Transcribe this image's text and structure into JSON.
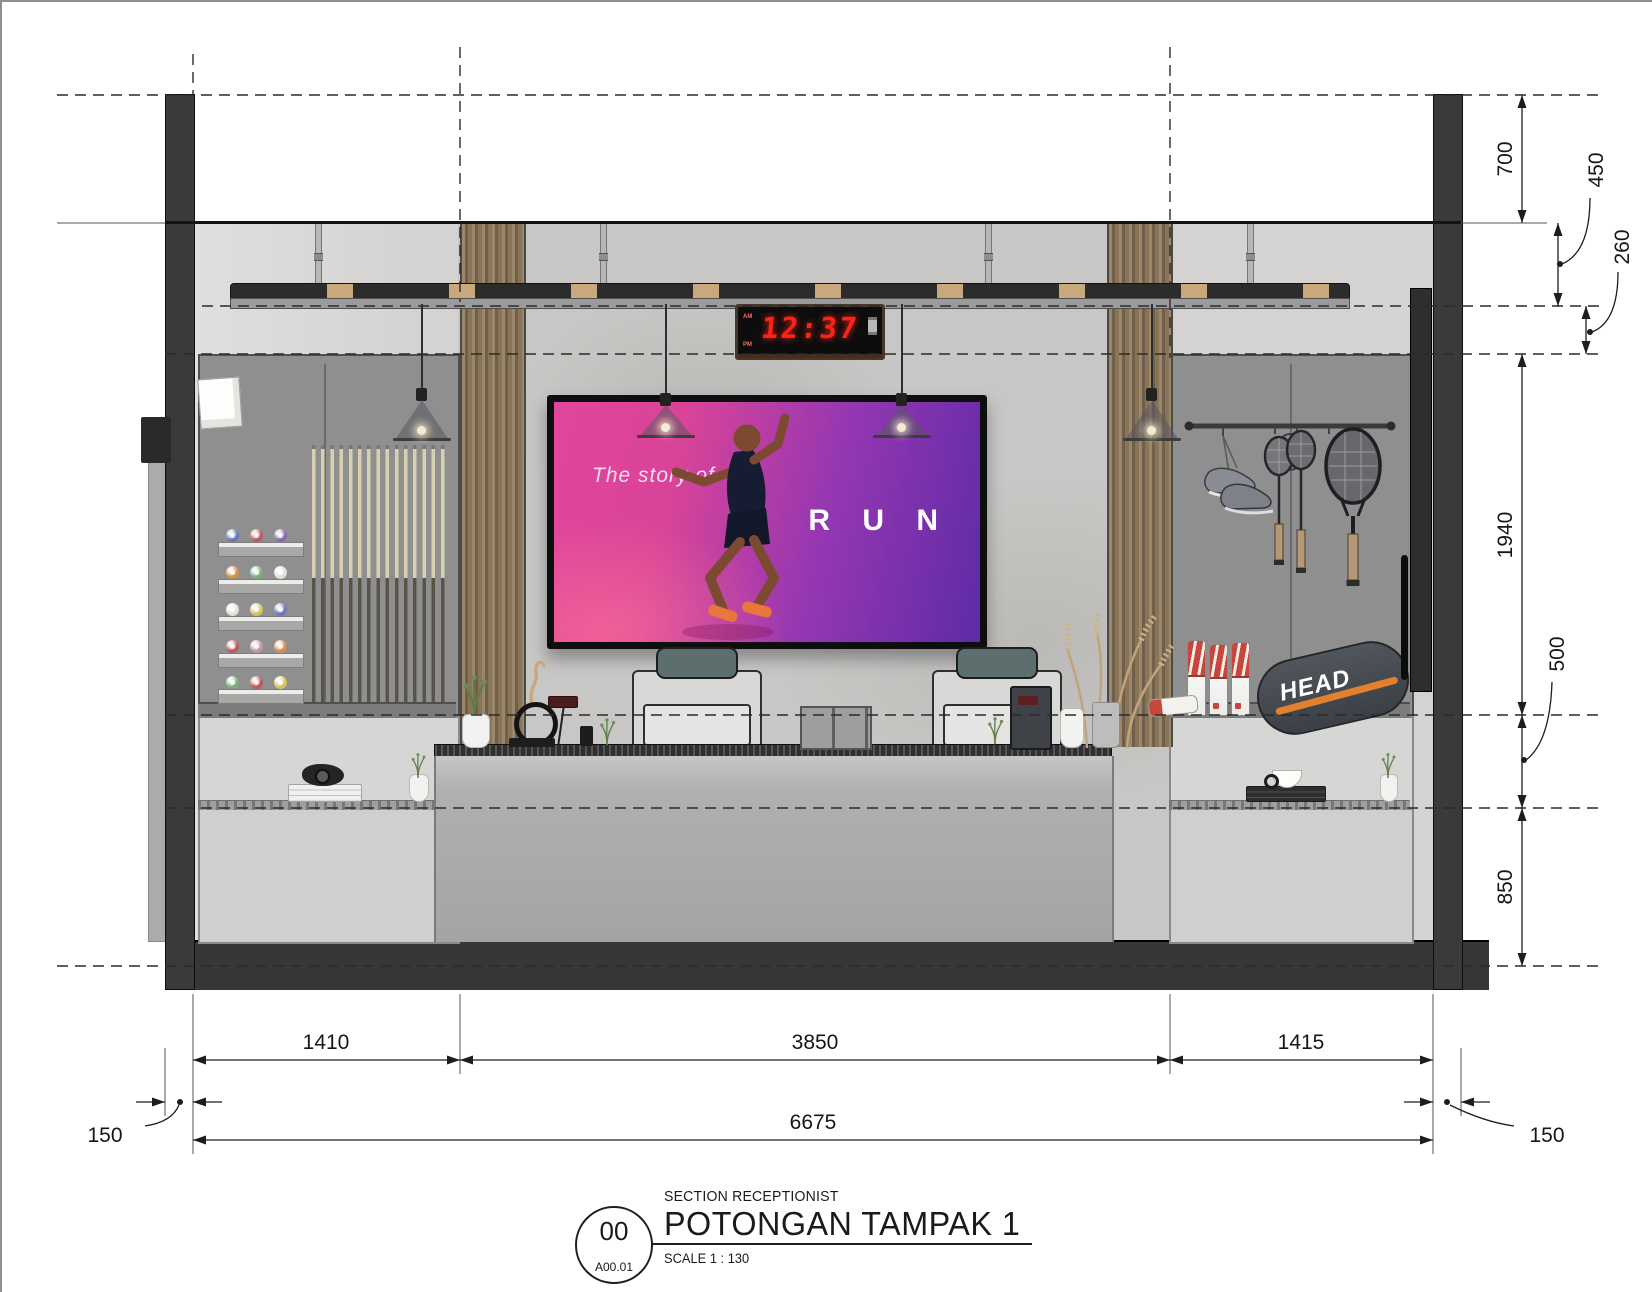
{
  "colors": {
    "clock_red": "#ff2016",
    "head_orange": "#e2802f",
    "tv_pink": "#d94498",
    "tv_purple": "#5e2ba6",
    "shoe_orange": "#e8763d",
    "wood_brown": "#8a7458",
    "wall_dark": "#3a3a3a",
    "concrete_gray": "#c8c7c5"
  },
  "title_block": {
    "detail_number": "00",
    "sheet_code": "A00.01",
    "subtitle": "SECTION RECEPTIONIST",
    "title": "POTONGAN TAMPAK 1",
    "scale": "SCALE  1 : 130"
  },
  "clock": {
    "time": "12:37",
    "am": "AM",
    "pm": "PM"
  },
  "tv": {
    "tagline": "The story of",
    "headline": "R U N"
  },
  "right_cabinet": {
    "bag_brand": "HEAD"
  },
  "dimensions": {
    "right": [
      "700",
      "450",
      "260",
      "1940",
      "500",
      "850"
    ],
    "bottom_segments": [
      "1410",
      "3850",
      "1415"
    ],
    "bottom_total": "6675",
    "wall_left": "150",
    "wall_right": "150"
  }
}
